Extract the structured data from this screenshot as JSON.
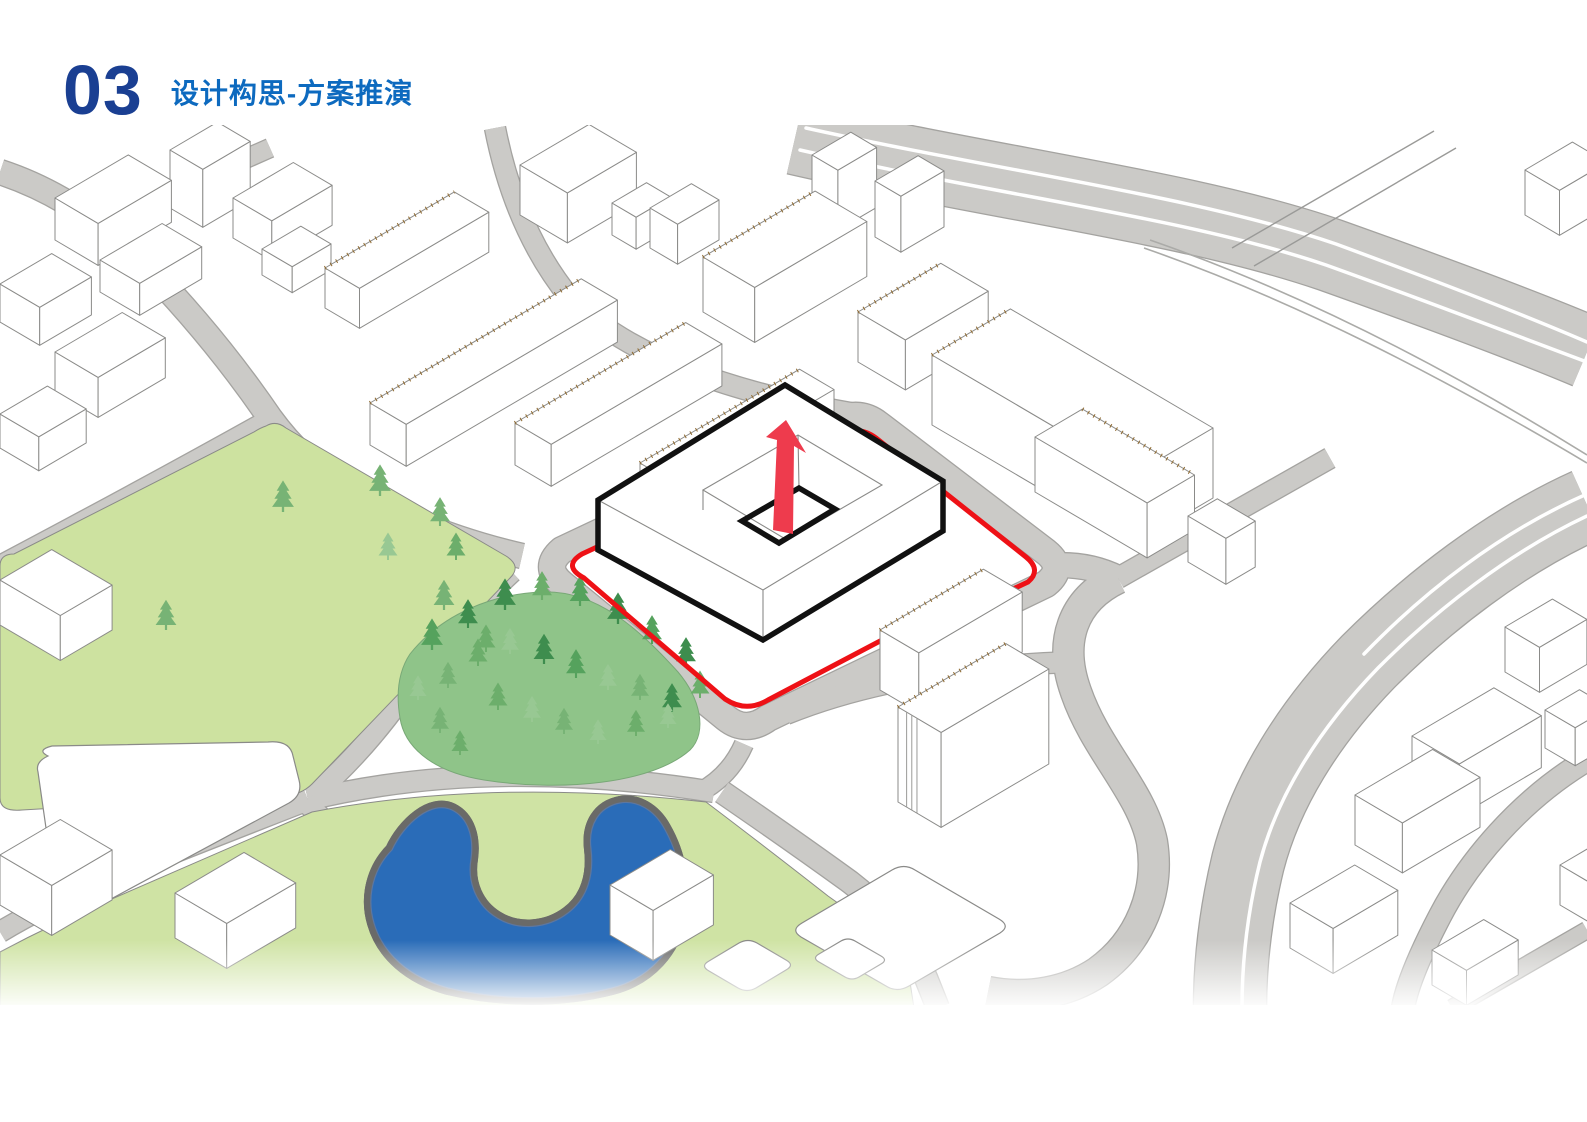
{
  "header": {
    "section_number": "03",
    "title": "设计构思-方案推演"
  },
  "colors": {
    "header_number": "#1a3f92",
    "header_title": "#0d6abf",
    "site_boundary_red": "#ee1116",
    "arrow_red": "#ee3b4d",
    "massing_black": "#111111",
    "park_green": "#cde2a0",
    "meadow_green": "#cfe3a4",
    "woods_green": "#8fc489",
    "pond_blue": "#2a6cb8",
    "road_gray": "#cbcac7",
    "road_edge_gray": "#a4a3a0",
    "building_fill": "#ffffff",
    "building_outline": "#8b8b89",
    "roof_dots_brown": "#8f6a30",
    "lane_marking_white": "#ffffff",
    "tree_greens": [
      "#3e8d4e",
      "#55a25d",
      "#6cae6b",
      "#77b375",
      "#98c893"
    ]
  }
}
